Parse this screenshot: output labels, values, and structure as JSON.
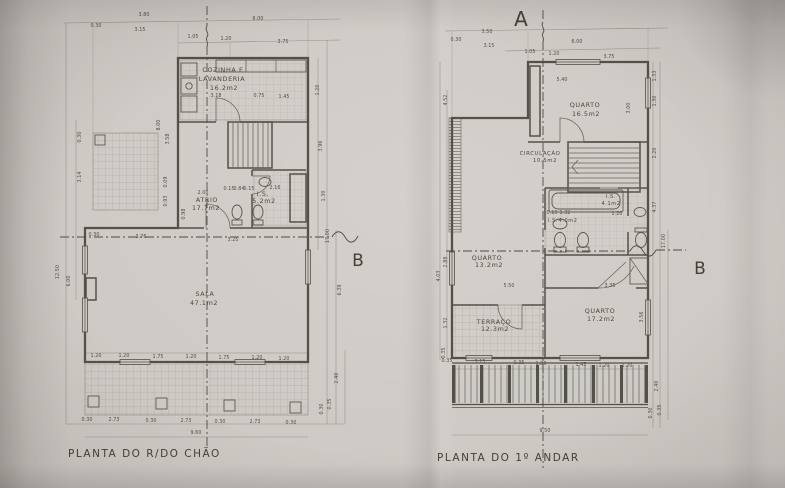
{
  "markers": {
    "a": "A",
    "b_left": "B",
    "b_right": "B"
  },
  "ground_floor": {
    "title": "PLANTA DO R/DO CHÃO",
    "rooms": {
      "kitchen_l1": "COZINHA E",
      "kitchen_l2": "LAVANDERIA",
      "kitchen_area": "16.2m2",
      "atrio": "ATRIO",
      "atrio_area": "17.7m2",
      "is": "I.S.",
      "is_area": "5.2m2",
      "sala": "SALA",
      "sala_area": "47.1m2"
    }
  },
  "first_floor": {
    "title": "PLANTA DO 1º ANDAR",
    "rooms": {
      "quarto1": "QUARTO",
      "quarto1_area": "16.5m2",
      "circulacao": "CIRCULAÇÃO",
      "circulacao_area": "10.5m2",
      "quarto2": "QUARTO",
      "quarto2_area": "13.2m2",
      "quarto3": "QUARTO",
      "quarto3_area": "17.2m2",
      "terraco": "TERRAÇO",
      "terraco_area": "12.3m2",
      "is1": "I.S.",
      "is1_area": "4.0m2",
      "is2": "I.S.",
      "is2_area": "4.1m2"
    }
  },
  "colors": {
    "paper": "#cdc9c4",
    "ink": "#54504a",
    "dim_text": "#514d46"
  },
  "dim_labels": [
    {
      "t": "3.80",
      "x": 144,
      "y": 16
    },
    {
      "t": "0.30",
      "x": 96,
      "y": 27
    },
    {
      "t": "3.15",
      "x": 140,
      "y": 31
    },
    {
      "t": "6.00",
      "x": 258,
      "y": 20
    },
    {
      "t": "1.05",
      "x": 193,
      "y": 38
    },
    {
      "t": "1.20",
      "x": 226,
      "y": 40
    },
    {
      "t": "3.75",
      "x": 283,
      "y": 43
    },
    {
      "t": "12.50",
      "x": 59,
      "y": 272,
      "r": 1
    },
    {
      "t": "6.00",
      "x": 70,
      "y": 281,
      "r": 1
    },
    {
      "t": "0.30",
      "x": 81,
      "y": 137,
      "r": 1
    },
    {
      "t": "3.14",
      "x": 81,
      "y": 177,
      "r": 1
    },
    {
      "t": "8.00",
      "x": 160,
      "y": 125,
      "r": 1
    },
    {
      "t": "3.58",
      "x": 169,
      "y": 139,
      "r": 1
    },
    {
      "t": "0.09",
      "x": 167,
      "y": 182,
      "r": 1
    },
    {
      "t": "0.93",
      "x": 167,
      "y": 201,
      "r": 1
    },
    {
      "t": "1.20",
      "x": 319,
      "y": 90,
      "r": 1
    },
    {
      "t": "3.96",
      "x": 322,
      "y": 146,
      "r": 1
    },
    {
      "t": "1.30",
      "x": 325,
      "y": 196,
      "r": 1
    },
    {
      "t": "17.00",
      "x": 329,
      "y": 236,
      "r": 1
    },
    {
      "t": "6.39",
      "x": 341,
      "y": 290,
      "r": 1
    },
    {
      "t": "2.40",
      "x": 338,
      "y": 378,
      "r": 1
    },
    {
      "t": "0.35",
      "x": 331,
      "y": 404,
      "r": 1
    },
    {
      "t": "0.30",
      "x": 323,
      "y": 409,
      "r": 1
    },
    {
      "t": "1.20",
      "x": 96,
      "y": 357
    },
    {
      "t": "1.20",
      "x": 124,
      "y": 357
    },
    {
      "t": "1.75",
      "x": 158,
      "y": 358
    },
    {
      "t": "1.20",
      "x": 191,
      "y": 358
    },
    {
      "t": "1.75",
      "x": 224,
      "y": 359
    },
    {
      "t": "1.20",
      "x": 257,
      "y": 359
    },
    {
      "t": "1.20",
      "x": 284,
      "y": 360
    },
    {
      "t": "0.30",
      "x": 87,
      "y": 421
    },
    {
      "t": "2.73",
      "x": 114,
      "y": 421
    },
    {
      "t": "0.30",
      "x": 151,
      "y": 422
    },
    {
      "t": "2.73",
      "x": 186,
      "y": 422
    },
    {
      "t": "0.30",
      "x": 220,
      "y": 423
    },
    {
      "t": "2.73",
      "x": 255,
      "y": 423
    },
    {
      "t": "0.30",
      "x": 291,
      "y": 424
    },
    {
      "t": "9.60",
      "x": 196,
      "y": 434
    },
    {
      "t": "3.18",
      "x": 216,
      "y": 97
    },
    {
      "t": "0.75",
      "x": 259,
      "y": 97
    },
    {
      "t": "1.45",
      "x": 284,
      "y": 98
    },
    {
      "t": "2.00",
      "x": 203,
      "y": 194
    },
    {
      "t": "0.98",
      "x": 185,
      "y": 214,
      "r": 1
    },
    {
      "t": "0.15",
      "x": 229,
      "y": 190
    },
    {
      "t": "0.84",
      "x": 239,
      "y": 190
    },
    {
      "t": "0.15",
      "x": 249,
      "y": 190
    },
    {
      "t": "2.16",
      "x": 275,
      "y": 189
    },
    {
      "t": "0.30",
      "x": 94,
      "y": 236
    },
    {
      "t": "3.76",
      "x": 141,
      "y": 238
    },
    {
      "t": "3.25",
      "x": 233,
      "y": 241
    },
    {
      "t": "3.50",
      "x": 487,
      "y": 33
    },
    {
      "t": "0.30",
      "x": 456,
      "y": 41
    },
    {
      "t": "3.15",
      "x": 489,
      "y": 47
    },
    {
      "t": "6.00",
      "x": 577,
      "y": 43
    },
    {
      "t": "1.05",
      "x": 530,
      "y": 53
    },
    {
      "t": "1.20",
      "x": 554,
      "y": 55
    },
    {
      "t": "3.75",
      "x": 609,
      "y": 58
    },
    {
      "t": "5.40",
      "x": 562,
      "y": 81
    },
    {
      "t": "3.00",
      "x": 630,
      "y": 108,
      "r": 1
    },
    {
      "t": "1.33",
      "x": 656,
      "y": 76,
      "r": 1
    },
    {
      "t": "1.30",
      "x": 656,
      "y": 101,
      "r": 1
    },
    {
      "t": "4.52",
      "x": 447,
      "y": 100,
      "r": 1
    },
    {
      "t": "2.20",
      "x": 656,
      "y": 153,
      "r": 1
    },
    {
      "t": "4.37",
      "x": 656,
      "y": 207,
      "r": 1
    },
    {
      "t": "17.00",
      "x": 665,
      "y": 241,
      "r": 1
    },
    {
      "t": "0.15",
      "x": 552,
      "y": 214
    },
    {
      "t": "1.32",
      "x": 565,
      "y": 214
    },
    {
      "t": "1.20",
      "x": 617,
      "y": 215
    },
    {
      "t": "2.88",
      "x": 447,
      "y": 262,
      "r": 1
    },
    {
      "t": "4.03",
      "x": 440,
      "y": 276,
      "r": 1
    },
    {
      "t": "5.50",
      "x": 509,
      "y": 287
    },
    {
      "t": "3.35",
      "x": 610,
      "y": 287
    },
    {
      "t": "3.56",
      "x": 643,
      "y": 317,
      "r": 1
    },
    {
      "t": "1.32",
      "x": 447,
      "y": 323,
      "r": 1
    },
    {
      "t": "0.35",
      "x": 445,
      "y": 353,
      "r": 1
    },
    {
      "t": "0.35",
      "x": 447,
      "y": 362
    },
    {
      "t": "3.15",
      "x": 480,
      "y": 363
    },
    {
      "t": "0.35",
      "x": 519,
      "y": 364
    },
    {
      "t": "1.80",
      "x": 541,
      "y": 365
    },
    {
      "t": "1.45",
      "x": 581,
      "y": 366
    },
    {
      "t": "1.20",
      "x": 604,
      "y": 367
    },
    {
      "t": "1.20",
      "x": 627,
      "y": 367
    },
    {
      "t": "2.40",
      "x": 658,
      "y": 386,
      "r": 1
    },
    {
      "t": "0.30",
      "x": 652,
      "y": 413,
      "r": 1
    },
    {
      "t": "0.35",
      "x": 661,
      "y": 410,
      "r": 1
    },
    {
      "t": "9.50",
      "x": 545,
      "y": 432
    }
  ]
}
